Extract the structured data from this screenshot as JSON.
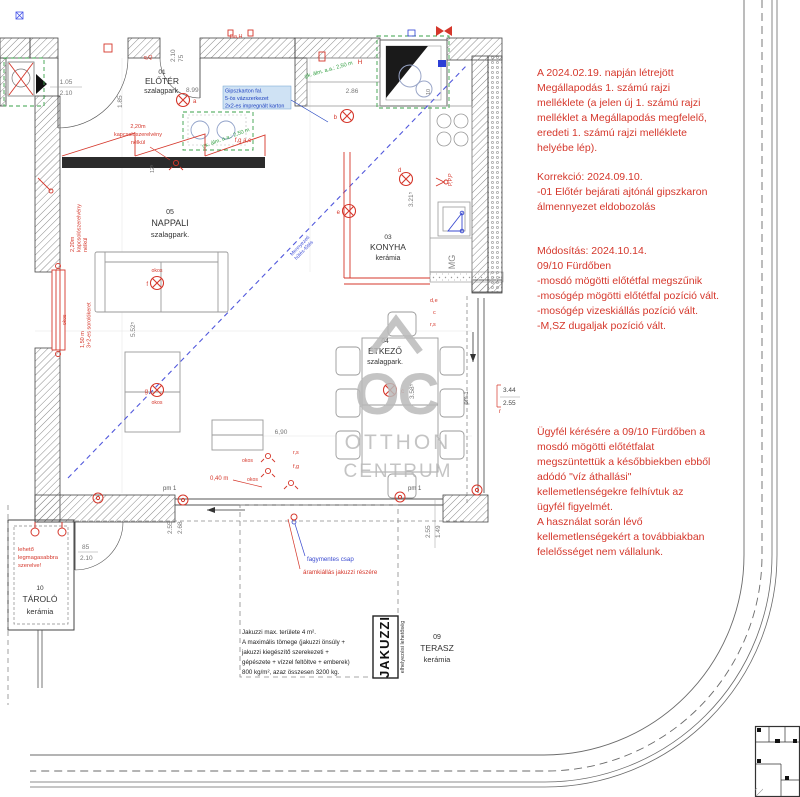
{
  "colors": {
    "red": "#d5372b",
    "blue": "#4150d8",
    "green": "#3aa04a",
    "wall_line": "#444444",
    "dim": "#777777",
    "watermark": "#bababa",
    "lightblue_bg": "#cfe2f4"
  },
  "rooms": {
    "eloter": {
      "num": "01",
      "name": "ELŐTÉR",
      "floor": "szalagpark."
    },
    "nappali": {
      "num": "05",
      "name": "NAPPALI",
      "floor": "szalagpark."
    },
    "konyha": {
      "num": "03",
      "name": "KONYHA",
      "floor": "kerámia"
    },
    "etkezo": {
      "num": "04",
      "name": "ÉTKEZŐ",
      "floor": "szalagpark."
    },
    "tarolo": {
      "num": "10",
      "name": "TÁROLÓ",
      "floor": "kerámia"
    },
    "terasz": {
      "num": "09",
      "name": "TERASZ",
      "floor": "kerámia"
    }
  },
  "notes": {
    "agreement": [
      "A 2024.02.19. napján létrejött",
      "Megállapodás 1. számú rajzi",
      "melléklete (a jelen új 1. számú rajzi",
      "melléklet a Megállapodás megfelelő,",
      "eredeti 1. számú rajzi melléklete",
      "helyébe lép)."
    ],
    "correction": [
      "Korrekció: 2024.09.10.",
      "-01 Előtér bejárati ajtónál gipszkaron",
      "álmennyezet eldobozolás"
    ],
    "modification": [
      "Módosítás: 2024.10.14.",
      "09/10 Fürdőben",
      "-mosdó mögötti előtétfal megszűnik",
      "-mosógép mögötti előtétfal pozíció vált.",
      "-mosógép vizeskiállás pozíció vált.",
      "-M,SZ dugaljak pozíció vált."
    ],
    "client": [
      "Ügyfél kérésére a 09/10 Fürdőben a",
      "mosdó mögötti előtétfalat",
      "megszüntettük a későbbiekben ebből",
      "adódó \"víz áthallási\"",
      "kellemetlenségekre felhívtuk az",
      "ügyfél figyelmét.",
      "A használat során lévő",
      "kellemetlenségekért a továbbiakban",
      "felelősséget nem vállalunk."
    ]
  },
  "watermark": {
    "logo": "OC",
    "line1": "OTTHON",
    "line2": "CENTRUM"
  },
  "jakuzzi": {
    "label": "JAKUZZI",
    "sublabel": "elhelyezési lehetőség",
    "note": [
      "Jakuzzi max. területe 4 m².",
      "A maximális tömege (jakuzzi önsúly +",
      "jakuzzi kiegészítő szerekezeti +",
      "gépészete + vízzel feltöltve + emberek)",
      "800 kg/m², azaz összesen 3200 kg."
    ]
  },
  "plan": {
    "gipszkarton": [
      "Gipszkarton fal.",
      "5-ös vázszerkezet",
      "2x2-es impregnált karton"
    ],
    "almennyezet": "gk. álm. a.a.: 2,50 m",
    "kapcsolo": [
      "2,20m",
      "kapcsolószerelvény",
      "nélkül"
    ],
    "sorolokeret": [
      "1,50 m",
      "3+2-es sorolókeret"
    ],
    "lehetoleg": [
      "lehető",
      "legmagasabbra",
      "szerelve!"
    ],
    "fagymentes": "fagymentes csap",
    "aramkiallas": "áramkiállás jakuzzi részére",
    "mg": "MG",
    "pm1": "pm 1",
    "okos": "okos",
    "diag": [
      "Mennyezeti",
      "hűtés-fűtés"
    ],
    "letters": {
      "a": "a",
      "b": "b",
      "c": "c",
      "d": "d",
      "e": "e",
      "f": "f",
      "g": "g",
      "de": "d,e",
      "rs": "r,s",
      "fg": "f,g",
      "fgac": "f,g a,c",
      "ppp": "P,P,P",
      "gah": "Ga,H",
      "q": "q,Q",
      "r": "r",
      "H": "H"
    }
  },
  "dims": {
    "entry_w": "1.05",
    "entry_h": "2.10",
    "door2_w": "75",
    "door2_h": "2.10",
    "eloter_w": "1.85",
    "eloter_l": "8.99",
    "bath_w": "2.86",
    "bath_t": "10",
    "konyha_l": "3.21⁵",
    "nappali_l": "5.52⁵",
    "etkezo_l": "3.58⁵",
    "terasz_w": "6,90",
    "wall_t": "12⁵",
    "tarolo_door_w": "85",
    "tarolo_door_h": "2.10",
    "left_a": "2.55",
    "left_b": "2.68",
    "right_a": "1.49",
    "right_b": "2.55",
    "win_w": "3.44",
    "win_h": "2.55",
    "dist": "0,40 m"
  }
}
